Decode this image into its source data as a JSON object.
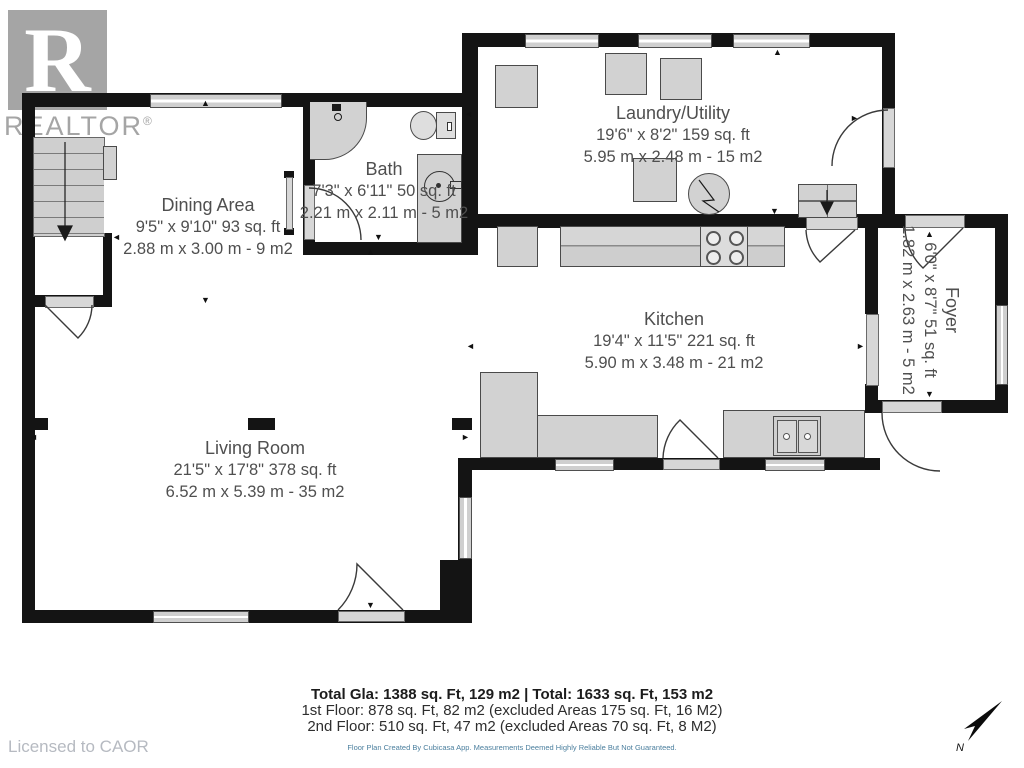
{
  "watermark": {
    "logo_letter": "R",
    "brand": "REALTOR",
    "registered_mark": "®"
  },
  "rooms": {
    "dining": {
      "name": "Dining Area",
      "imperial": "9'5\" x 9'10\" 93 sq. ft",
      "metric": "2.88 m x 3.00 m - 9 m2"
    },
    "bath": {
      "name": "Bath",
      "imperial": "7'3\" x 6'11\" 50 sq. ft",
      "metric": "2.21 m x 2.11 m - 5 m2"
    },
    "laundry": {
      "name": "Laundry/Utility",
      "imperial": "19'6\" x 8'2\" 159 sq. ft",
      "metric": "5.95 m x 2.48 m - 15 m2"
    },
    "kitchen": {
      "name": "Kitchen",
      "imperial": "19'4\" x 11'5\" 221 sq. ft",
      "metric": "5.90 m x 3.48 m - 21 m2"
    },
    "foyer": {
      "name": "Foyer",
      "imperial": "6'0\" x 8'7\" 51 sq. ft",
      "metric": "1.82 m x 2.63 m - 5 m2"
    },
    "living": {
      "name": "Living Room",
      "imperial": "21'5\" x 17'8\" 378 sq. ft",
      "metric": "6.52 m x 5.39 m - 35 m2"
    }
  },
  "footer": {
    "total_line": "Total Gla: 1388 sq. Ft, 129 m2 | Total: 1633 sq. Ft, 153 m2",
    "first_floor_line": "1st Floor: 878 sq. Ft, 82 m2 (excluded Areas 175 sq. Ft, 16 M2)",
    "second_floor_line": "2nd Floor: 510 sq. Ft, 47 m2 (excluded Areas 70 sq. Ft, 8 M2)",
    "disclaimer": "Floor Plan Created By Cubicasa App. Measurements Deemed Highly Reliable But Not Guaranteed.",
    "licensed_to": "Licensed to CAOR"
  },
  "compass": {
    "north_label": "N"
  },
  "colors": {
    "wall": "#141414",
    "furniture": "#d2d2d2",
    "furniture_border": "#4a4a4a",
    "label_text": "#4f4f4f",
    "disclaimer_text": "#4b7f9e",
    "watermark_gray": "#a5a5a5",
    "licensed_text": "#b6bac1"
  }
}
